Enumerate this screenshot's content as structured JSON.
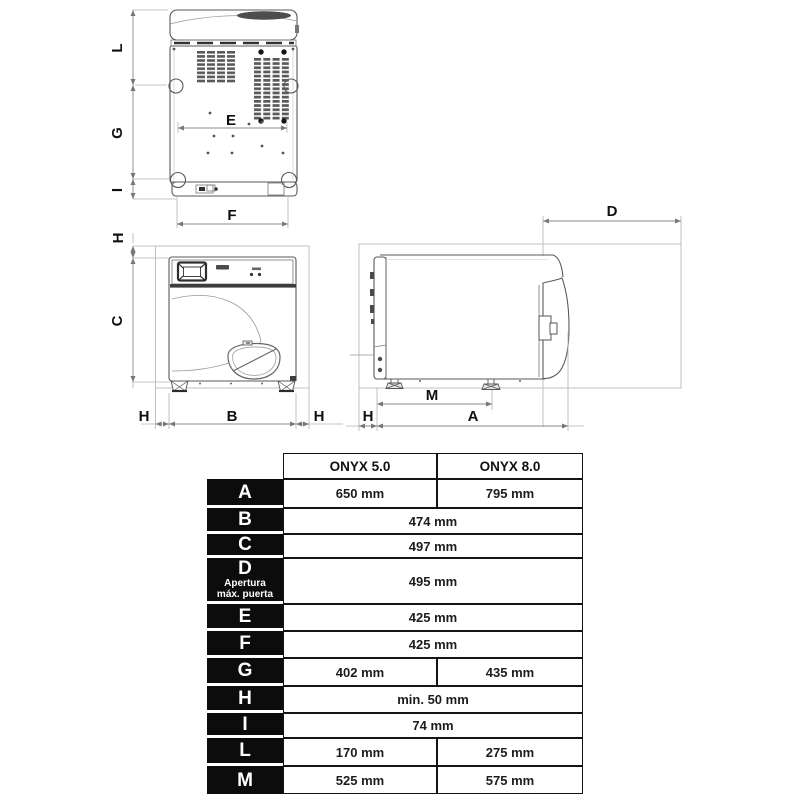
{
  "views": {
    "top": {
      "left_labels": [
        "L",
        "G",
        "I"
      ],
      "inner_label": "E",
      "bottom_label": "F"
    },
    "front": {
      "top_label": "H",
      "left_label": "C",
      "bottom_labels": [
        "H",
        "B",
        "H"
      ]
    },
    "side": {
      "top_label": "D",
      "bottom_labels": [
        "H",
        "M",
        "A"
      ]
    }
  },
  "table": {
    "columns": [
      "ONYX 5.0",
      "ONYX 8.0"
    ],
    "rows": [
      {
        "label": "A",
        "values": [
          "650 mm",
          "795 mm"
        ]
      },
      {
        "label": "B",
        "values": [
          "474 mm"
        ]
      },
      {
        "label": "C",
        "values": [
          "497 mm"
        ]
      },
      {
        "label": "D",
        "sublabel_1": "Apertura",
        "sublabel_2": "máx. puerta",
        "values": [
          "495 mm"
        ]
      },
      {
        "label": "E",
        "values": [
          "425 mm"
        ]
      },
      {
        "label": "F",
        "values": [
          "425 mm"
        ]
      },
      {
        "label": "G",
        "values": [
          "402 mm",
          "435 mm"
        ]
      },
      {
        "label": "H",
        "values": [
          "min. 50 mm"
        ]
      },
      {
        "label": "I",
        "values": [
          "74 mm"
        ]
      },
      {
        "label": "L",
        "values": [
          "170 mm",
          "275 mm"
        ]
      },
      {
        "label": "M",
        "values": [
          "525 mm",
          "575 mm"
        ]
      }
    ]
  },
  "colors": {
    "line": "#5a5a5a",
    "dim_line": "#8a8a8a",
    "table_black": "#0c0c0c",
    "background": "#ffffff"
  }
}
